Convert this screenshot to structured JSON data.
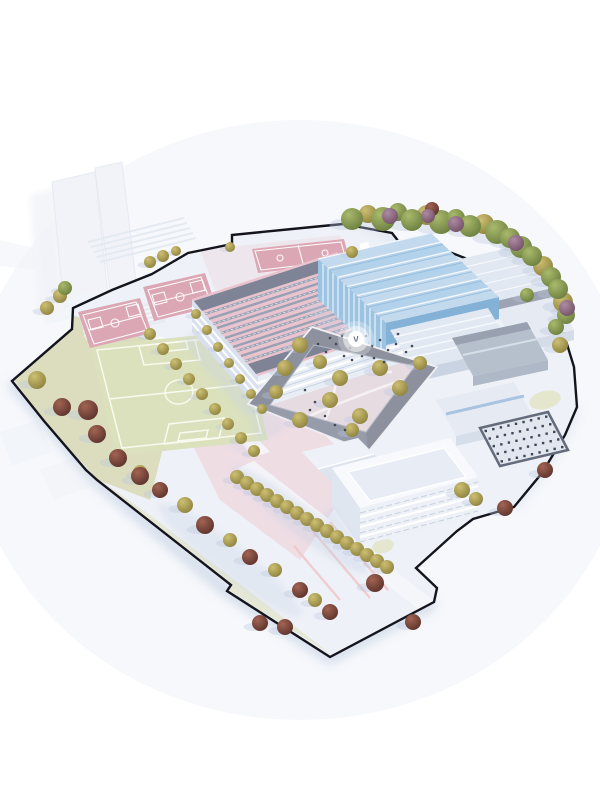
{
  "meta": {
    "kind": "architectural-site-plan-rendering",
    "view": "aerial-axonometric",
    "subject": "school-campus-masterplan-model"
  },
  "palette": {
    "bg": "#ffffff",
    "backdrop": "#f6f8fb",
    "ground": "#eef1f7",
    "boundary": "#14141d",
    "lawn": "#dcddbf",
    "lawnLight": "#e4e6cd",
    "field": "#dbe1bc",
    "fieldLine": "#f8faf0",
    "courtPink": "#dca7b5",
    "courtLine": "#ffffff",
    "plazaPink": "#eed9e0",
    "plazaLav": "#e5dae2",
    "courtyardFloor": "#e7dbe2",
    "pathWhite": "#f7f3f5",
    "pinkPath": "#f0c6ca",
    "roofPink": "#e9c3cd",
    "roofDark": "#7e8495",
    "solar": "#98a1b3",
    "facadeLight": "#e9eef6",
    "facadeShade": "#d9e1ee",
    "blueFacade": "#9cc4e2",
    "blueFacadeShade": "#84b2d6",
    "blueRoof": "#c3daee",
    "blueRoofAlt": "#b2d1ea",
    "ridgeWhite": "#f2f7fc",
    "greyWall": "#e6ebf3",
    "greyRoof": "#e2e8f1",
    "darkBlock": "#b6bfcc",
    "ringRoof": "#8c919d",
    "slabWall": "#edf1f7",
    "slabRoof": "#f7f9fc",
    "skylight": "#e8edf5",
    "carparkBg": "#e2e7ef",
    "carparkFrame": "#646b7a",
    "carparkDot": "#3f4554",
    "shadow": "#c7d2e6",
    "treeShadow": "#b9c7de",
    "ghost": "#f1f3f8",
    "ghostEdge": "#e3e8f0",
    "people": "#41485a",
    "marker": "#ffffff",
    "markerGlyph": "#6b7280",
    "treeOliveLight": "#cdbf72",
    "treeOlive": "#8f8440",
    "treeGreenLight": "#a9ba6c",
    "treeGreen": "#6d8040",
    "treeMaroonLight": "#a26453",
    "treeMaroon": "#5e342d",
    "treePurpleLight": "#ad8ba3",
    "treePurple": "#745269"
  },
  "marker": {
    "x": 356,
    "y": 339
  },
  "features": [
    "site-boundary",
    "soccer-field",
    "basketball-courts",
    "classroom-building-pink",
    "sports-hall-blue",
    "courtyard-ring-building",
    "campus-plaza",
    "workshop-halls",
    "parking-grid",
    "tree-rows",
    "context-buildings",
    "bleacher-steps"
  ],
  "carpark": {
    "cols": 9,
    "rows": 5
  },
  "trees": {
    "olive": [
      [
        368,
        214,
        9
      ],
      [
        427,
        215,
        10
      ],
      [
        484,
        224,
        10
      ],
      [
        543,
        266,
        10
      ],
      [
        563,
        302,
        10
      ],
      [
        150,
        262,
        6
      ],
      [
        163,
        256,
        6
      ],
      [
        176,
        251,
        5
      ],
      [
        230,
        247,
        5
      ],
      [
        352,
        252,
        6
      ],
      [
        37,
        380,
        9
      ],
      [
        60,
        296,
        7
      ],
      [
        47,
        308,
        7
      ],
      [
        150,
        334,
        6
      ],
      [
        163,
        349,
        6
      ],
      [
        176,
        364,
        6
      ],
      [
        189,
        379,
        6
      ],
      [
        202,
        394,
        6
      ],
      [
        215,
        409,
        6
      ],
      [
        228,
        424,
        6
      ],
      [
        241,
        438,
        6
      ],
      [
        254,
        451,
        6
      ],
      [
        196,
        314,
        5
      ],
      [
        207,
        330,
        5
      ],
      [
        218,
        347,
        5
      ],
      [
        229,
        363,
        5
      ],
      [
        240,
        379,
        5
      ],
      [
        251,
        394,
        5
      ],
      [
        262,
        409,
        5
      ],
      [
        237,
        477,
        7
      ],
      [
        247,
        483,
        7
      ],
      [
        257,
        489,
        7
      ],
      [
        267,
        495,
        7
      ],
      [
        277,
        501,
        7
      ],
      [
        287,
        507,
        7
      ],
      [
        297,
        513,
        7
      ],
      [
        307,
        519,
        7
      ],
      [
        317,
        525,
        7
      ],
      [
        327,
        531,
        7
      ],
      [
        337,
        537,
        7
      ],
      [
        347,
        543,
        7
      ],
      [
        357,
        549,
        7
      ],
      [
        367,
        555,
        7
      ],
      [
        377,
        561,
        7
      ],
      [
        387,
        567,
        7
      ],
      [
        140,
        472,
        7
      ],
      [
        185,
        505,
        8
      ],
      [
        230,
        540,
        7
      ],
      [
        275,
        570,
        7
      ],
      [
        315,
        600,
        7
      ],
      [
        300,
        345,
        8
      ],
      [
        285,
        368,
        8
      ],
      [
        320,
        362,
        7
      ],
      [
        340,
        378,
        8
      ],
      [
        380,
        368,
        8
      ],
      [
        400,
        388,
        8
      ],
      [
        330,
        400,
        8
      ],
      [
        300,
        420,
        8
      ],
      [
        360,
        416,
        8
      ],
      [
        276,
        392,
        7
      ],
      [
        352,
        430,
        7
      ],
      [
        560,
        345,
        8
      ],
      [
        462,
        490,
        8
      ],
      [
        476,
        499,
        7
      ],
      [
        420,
        363,
        7
      ]
    ],
    "green": [
      [
        352,
        219,
        11
      ],
      [
        383,
        219,
        12
      ],
      [
        398,
        212,
        9
      ],
      [
        412,
        220,
        11
      ],
      [
        441,
        222,
        12
      ],
      [
        456,
        218,
        9
      ],
      [
        470,
        226,
        11
      ],
      [
        497,
        232,
        12
      ],
      [
        510,
        238,
        10
      ],
      [
        521,
        247,
        11
      ],
      [
        532,
        256,
        10
      ],
      [
        551,
        277,
        10
      ],
      [
        558,
        289,
        10
      ],
      [
        566,
        315,
        9
      ],
      [
        556,
        327,
        8
      ],
      [
        527,
        295,
        7
      ],
      [
        65,
        288,
        7
      ]
    ],
    "maroon": [
      [
        88,
        410,
        10
      ],
      [
        97,
        434,
        9
      ],
      [
        62,
        407,
        9
      ],
      [
        118,
        458,
        9
      ],
      [
        160,
        490,
        8
      ],
      [
        205,
        525,
        9
      ],
      [
        250,
        557,
        8
      ],
      [
        300,
        590,
        8
      ],
      [
        330,
        612,
        8
      ],
      [
        260,
        623,
        8
      ],
      [
        285,
        627,
        8
      ],
      [
        375,
        583,
        9
      ],
      [
        413,
        622,
        8
      ],
      [
        505,
        508,
        8
      ],
      [
        545,
        470,
        8
      ],
      [
        432,
        209,
        7
      ],
      [
        140,
        476,
        9
      ]
    ],
    "purple": [
      [
        390,
        216,
        8
      ],
      [
        456,
        224,
        8
      ],
      [
        516,
        243,
        8
      ],
      [
        567,
        308,
        8
      ],
      [
        428,
        216,
        7
      ]
    ]
  },
  "people": [
    [
      330,
      338
    ],
    [
      336,
      344
    ],
    [
      342,
      336
    ],
    [
      350,
      348
    ],
    [
      360,
      342
    ],
    [
      366,
      336
    ],
    [
      372,
      346
    ],
    [
      380,
      340
    ],
    [
      388,
      350
    ],
    [
      396,
      344
    ],
    [
      326,
      352
    ],
    [
      318,
      344
    ],
    [
      406,
      352
    ],
    [
      412,
      346
    ],
    [
      398,
      334
    ],
    [
      344,
      356
    ],
    [
      352,
      360
    ],
    [
      362,
      356
    ],
    [
      374,
      358
    ],
    [
      384,
      362
    ],
    [
      305,
      390
    ],
    [
      315,
      402
    ],
    [
      325,
      416
    ],
    [
      335,
      425
    ],
    [
      345,
      430
    ],
    [
      310,
      410
    ]
  ]
}
